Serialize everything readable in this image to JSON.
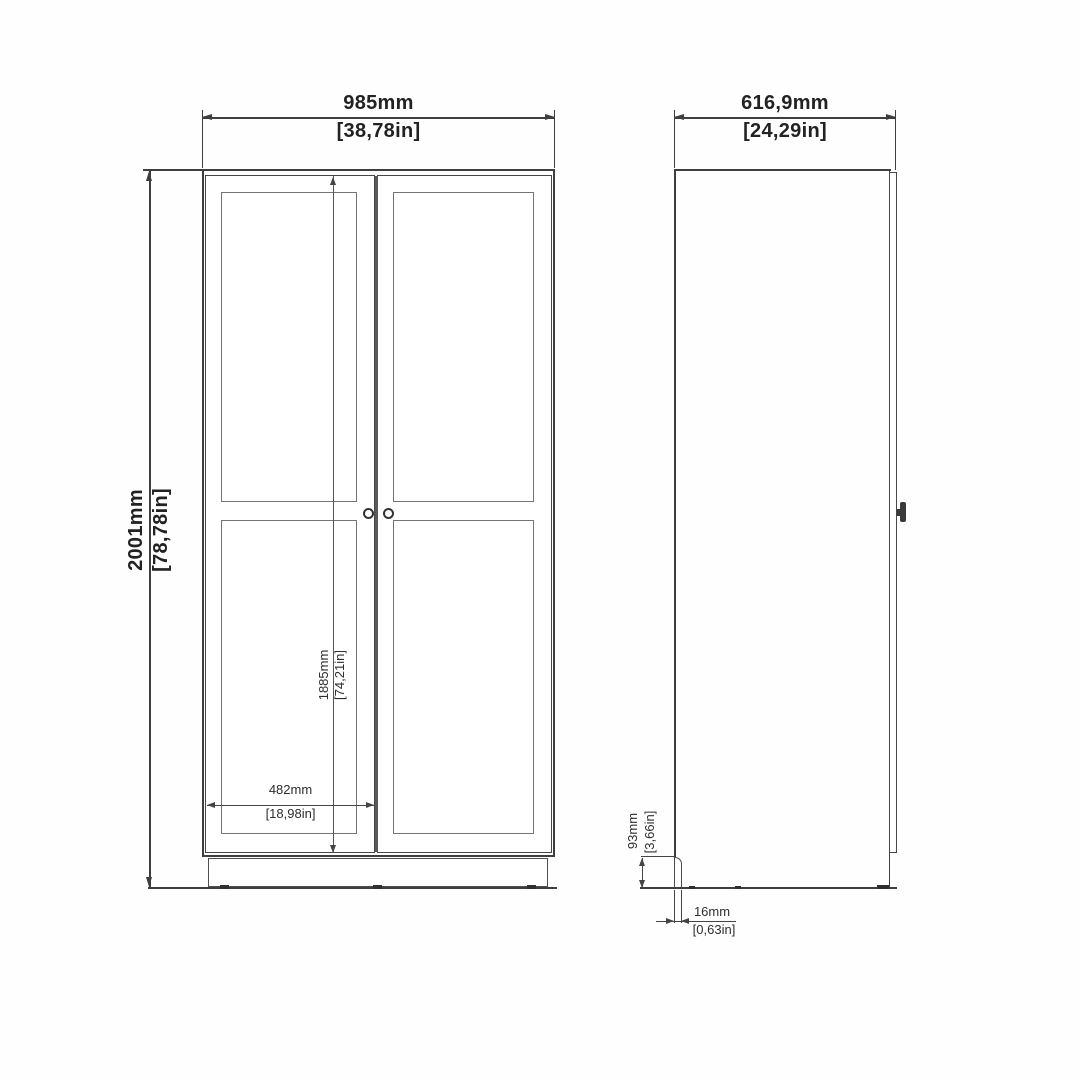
{
  "drawing": {
    "front_view": {
      "width": {
        "mm": "985mm",
        "in": "[38,78in]"
      },
      "height": {
        "mm": "2001mm",
        "in": "[78,78in]"
      },
      "door_height": {
        "mm": "1885mm",
        "in": "[74,21in]"
      },
      "door_width": {
        "mm": "482mm",
        "in": "[18,98in]"
      }
    },
    "side_view": {
      "depth": {
        "mm": "616,9mm",
        "in": "[24,29in]"
      },
      "plinth_height": {
        "mm": "93mm",
        "in": "[3,66in]"
      },
      "panel_thickness": {
        "mm": "16mm",
        "in": "[0,63in]"
      }
    },
    "colors": {
      "line": "#3e3e3e",
      "text": "#222222",
      "background": "#fefefe"
    }
  }
}
